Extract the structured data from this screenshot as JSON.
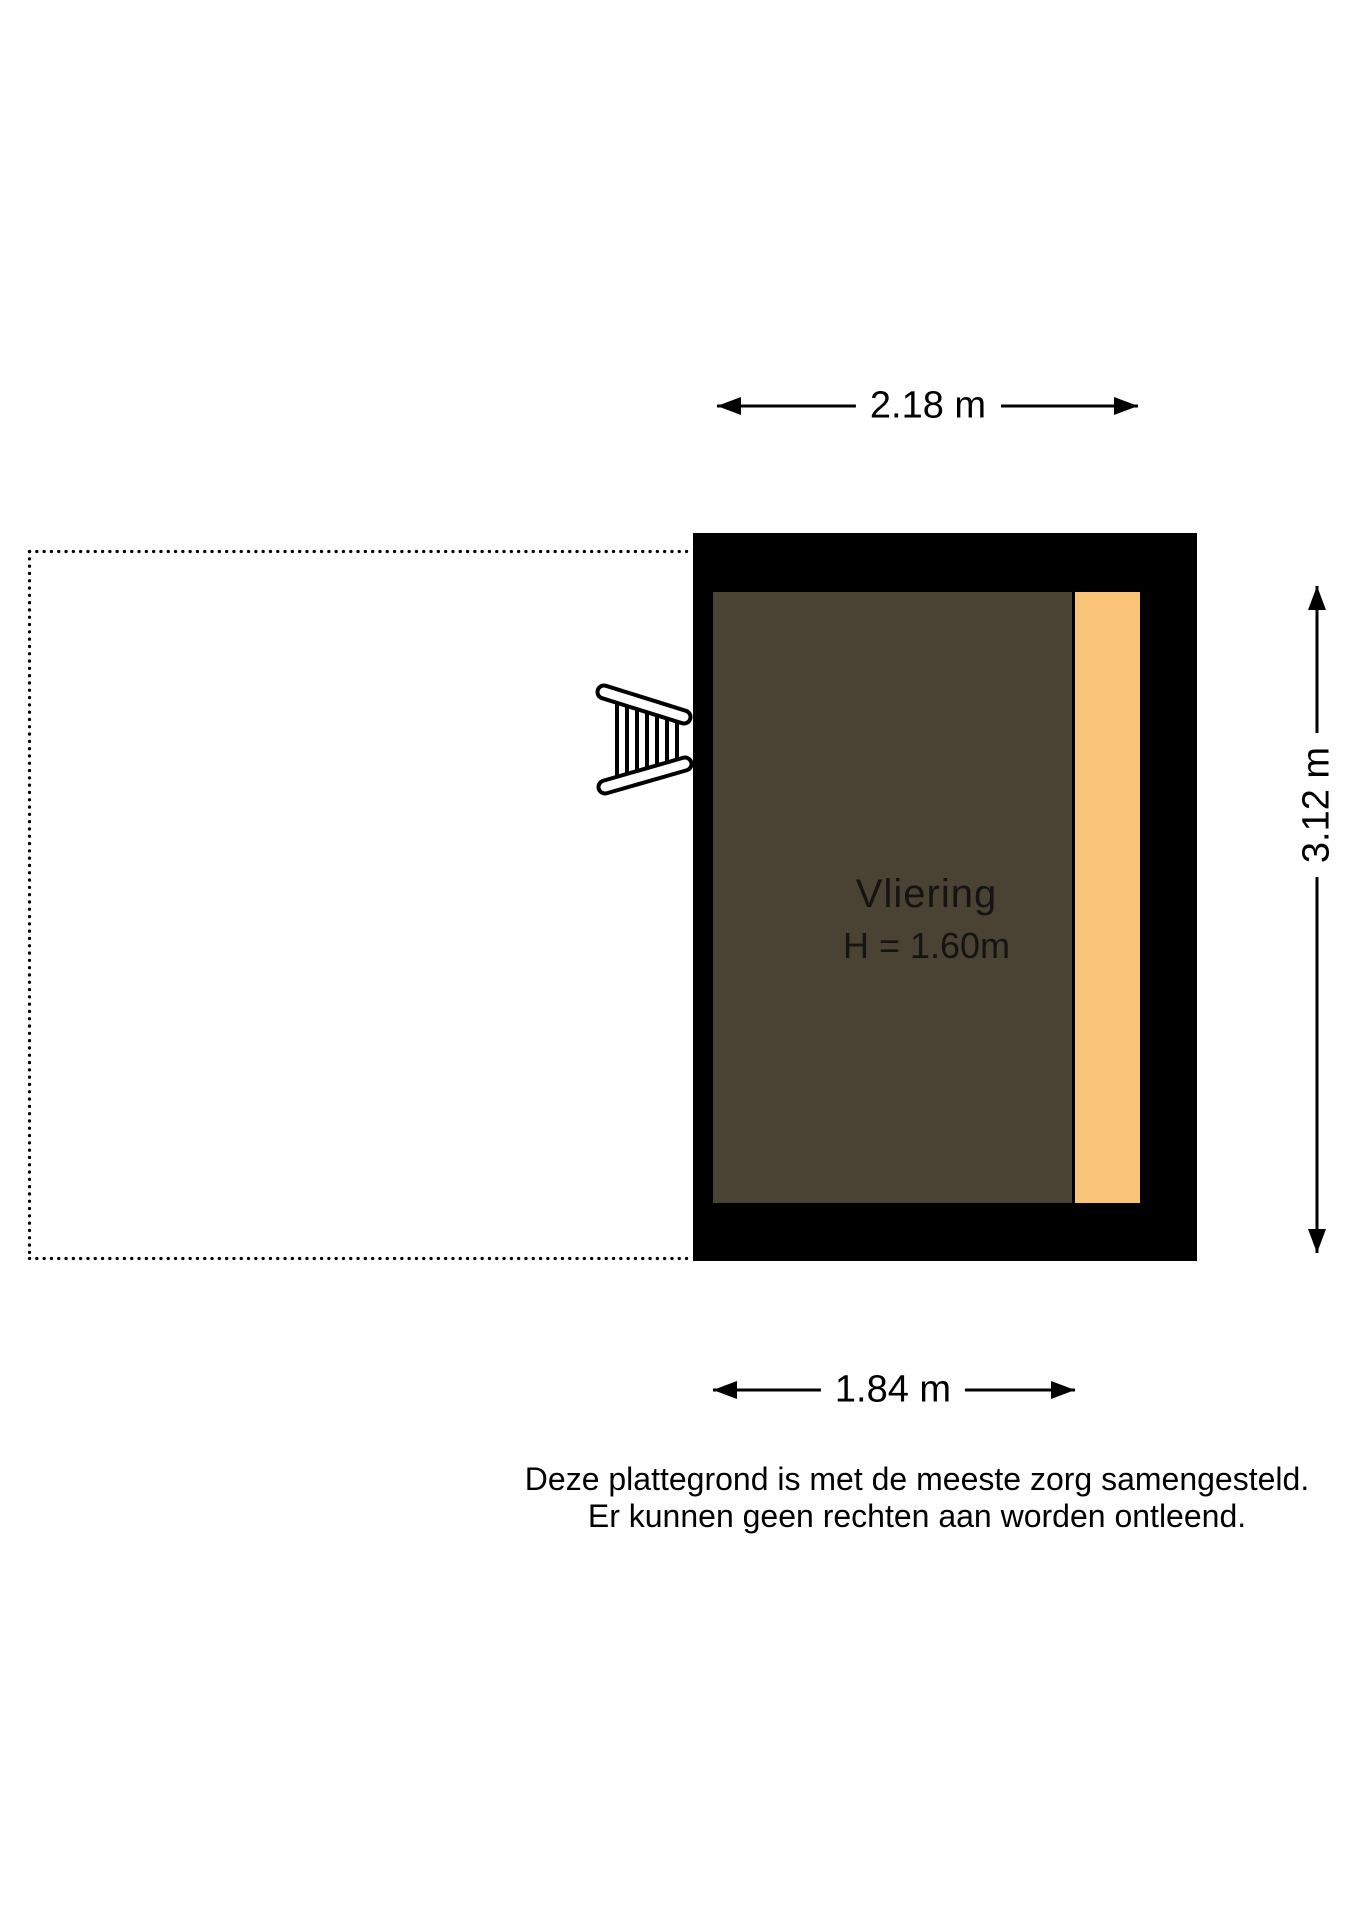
{
  "floorplan": {
    "room": {
      "name_label": "Vliering",
      "height_label": "H = 1.60m"
    },
    "dimensions": {
      "top": "2.18 m",
      "right": "3.12 m",
      "bottom": "1.84 m"
    },
    "disclaimer": {
      "line1": "Deze plattegrond is met de meeste zorg samengesteld.",
      "line2": "Er kunnen geen rechten aan worden ontleend."
    },
    "colors": {
      "wall": "#000000",
      "floor": "#4a4334",
      "strip": "#f9c477",
      "background": "#ffffff"
    },
    "icons": {
      "ladder": "ladder-icon"
    }
  }
}
